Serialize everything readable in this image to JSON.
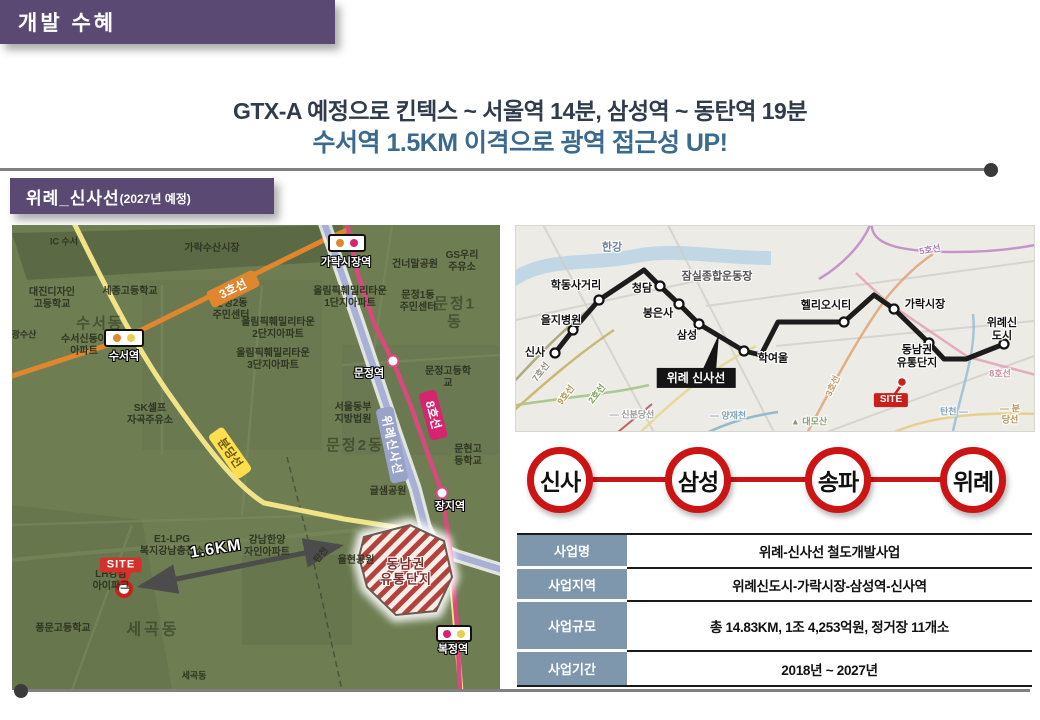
{
  "colors": {
    "banner-purple": "#5a4973",
    "headline-dark": "#303c4c",
    "headline-blue": "#3a6a8e",
    "line-red": "#cc1414",
    "table-header-bg": "#7e97ad",
    "site-red": "#d3322c",
    "map-olive": "#6e7d52",
    "divider-gray": "#808080"
  },
  "header": {
    "tag": "개발 수혜",
    "line1": "GTX-A 예정으로  킨텍스 ~ 서울역 14분, 삼성역 ~ 동탄역 19분",
    "line2": "수서역 1.5KM 이격으로 광역 접근성 UP!"
  },
  "section": {
    "title": "위례_신사선",
    "subtitle": "(2027년 예정)"
  },
  "left_map": {
    "badges": [
      {
        "x": 92,
        "y": 104,
        "w": 40,
        "h": 18,
        "dots": [
          "#e0862f",
          "#e8cf4f"
        ],
        "label": "수서역",
        "lx": 112,
        "ly": 132
      },
      {
        "x": 316,
        "y": 9,
        "w": 38,
        "h": 18,
        "dots": [
          "#e0862f",
          "#d6246e"
        ],
        "label": "가락시장역",
        "lx": 334,
        "ly": 38
      },
      {
        "x": 424,
        "y": 400,
        "w": 36,
        "h": 17,
        "dots": [
          "#d6246e",
          "#e8cf4f"
        ],
        "label": "복정역",
        "lx": 441,
        "ly": 425
      }
    ],
    "labels": [
      {
        "t": "IC 수서",
        "x": 52,
        "y": 17,
        "fs": 9
      },
      {
        "t": "가락수산시장",
        "x": 200,
        "y": 24,
        "fs": 10
      },
      {
        "t": "대진디자인\n고등학교",
        "x": 40,
        "y": 74
      },
      {
        "t": "세종고등학교",
        "x": 118,
        "y": 67
      },
      {
        "t": "수서동",
        "x": 88,
        "y": 99,
        "fs": 15,
        "c": "rgba(42,48,30,0.55)",
        "ls": 2
      },
      {
        "t": "수서신동아\n아파트",
        "x": 72,
        "y": 121
      },
      {
        "t": "광수산",
        "x": 12,
        "y": 110,
        "fs": 9
      },
      {
        "t": "문정2동\n주민센터",
        "x": 219,
        "y": 85
      },
      {
        "t": "올림픽훼밀리타운\n1단지아파트",
        "x": 338,
        "y": 73
      },
      {
        "t": "올림픽훼밀리타운\n2단지아파트",
        "x": 266,
        "y": 104
      },
      {
        "t": "올림픽훼밀리타운\n3단지아파트",
        "x": 261,
        "y": 135
      },
      {
        "t": "건너말공원",
        "x": 403,
        "y": 40
      },
      {
        "t": "GS우리\n주유소",
        "x": 450,
        "y": 37
      },
      {
        "t": "문정1동\n주민센터",
        "x": 406,
        "y": 77
      },
      {
        "t": "문정1동",
        "x": 443,
        "y": 88,
        "fs": 15,
        "c": "rgba(42,48,30,0.55)",
        "ls": 2
      },
      {
        "t": "문정고등학교",
        "x": 436,
        "y": 153
      },
      {
        "t": "SK셀프\n자곡주유소",
        "x": 138,
        "y": 190
      },
      {
        "t": "서울동부\n지방법원",
        "x": 341,
        "y": 189
      },
      {
        "t": "문정2동",
        "x": 343,
        "y": 221,
        "fs": 15,
        "c": "rgba(42,48,30,0.55)",
        "ls": 2
      },
      {
        "t": "문현고등학교",
        "x": 456,
        "y": 231
      },
      {
        "t": "글샘공원",
        "x": 376,
        "y": 267
      },
      {
        "t": "E1-LPG\n복지강남충전소",
        "x": 160,
        "y": 321
      },
      {
        "t": "강남한양\n자인아파트",
        "x": 255,
        "y": 322
      },
      {
        "t": "율현공원",
        "x": 344,
        "y": 336
      },
      {
        "t": "탄천",
        "x": 309,
        "y": 330,
        "rot": -50,
        "fs": 9
      },
      {
        "t": "LH강남\n아이파크",
        "x": 99,
        "y": 356
      },
      {
        "t": "풍문고등학교",
        "x": 51,
        "y": 404
      },
      {
        "t": "세곡동",
        "x": 141,
        "y": 406,
        "fs": 16,
        "c": "rgba(42,48,30,0.55)",
        "ls": 3
      },
      {
        "t": "세곡동",
        "x": 182,
        "y": 451,
        "fs": 9
      },
      {
        "t": "문정역",
        "x": 357,
        "y": 149,
        "c": "#fff",
        "fs": 11,
        "halo": "b",
        "n": "munjeong-station-label"
      },
      {
        "t": "장지역",
        "x": 438,
        "y": 282,
        "c": "#fff",
        "fs": 11,
        "halo": "b",
        "n": "jangji-station-label"
      },
      {
        "t": "동남권\n유통단지",
        "x": 394,
        "y": 347,
        "c": "#7c2f2a",
        "fs": 13,
        "halo": "w",
        "ls": 1,
        "n": "dongnamkwon-area-label"
      },
      {
        "t": "1.6KM",
        "x": 204,
        "y": 325,
        "c": "#fff",
        "fs": 16,
        "halo": "b",
        "rot": -9,
        "ls": 1,
        "n": "distance-label"
      },
      {
        "t": "3호선",
        "x": 221,
        "y": 64,
        "c": "#fff",
        "bg": "#e0862f",
        "fs": 12,
        "rot": -26,
        "pad": "2px 12px",
        "r": 4,
        "n": "line3-badge"
      },
      {
        "t": "분당선",
        "x": 218,
        "y": 228,
        "c": "#6b5a10",
        "bg": "#ffdf4d",
        "fs": 12,
        "rot": 55,
        "pad": "2px 10px",
        "r": 4,
        "n": "bundang-line-badge"
      },
      {
        "t": "위례신사선",
        "x": 380,
        "y": 220,
        "c": "#fff",
        "bg": "#99a2c8",
        "fs": 12,
        "rot": 78,
        "pad": "2px 8px",
        "r": 4,
        "ls": 1,
        "n": "wirye-sinsa-line-badge"
      },
      {
        "t": "8호선",
        "x": 421,
        "y": 190,
        "c": "#fff",
        "bg": "#d6246e",
        "fs": 12,
        "rot": 75,
        "pad": "2px 10px",
        "r": 4,
        "n": "line8-badge"
      },
      {
        "t": "SITE",
        "x": 109,
        "y": 340,
        "c": "#fff",
        "bg": "#d3322c",
        "fs": 11,
        "pad": "1px 7px",
        "r": 3,
        "ls": 1,
        "n": "site-badge"
      }
    ]
  },
  "right_map": {
    "labels": [
      {
        "t": "한강",
        "x": 96,
        "y": 22,
        "fs": 11,
        "c": "#6f85a0"
      },
      {
        "t": "학동사거리",
        "x": 60,
        "y": 60
      },
      {
        "t": "을지병원",
        "x": 45,
        "y": 95
      },
      {
        "t": "신사",
        "x": 19,
        "y": 127
      },
      {
        "t": "청담",
        "x": 126,
        "y": 63
      },
      {
        "t": "봉은사",
        "x": 142,
        "y": 88
      },
      {
        "t": "삼성",
        "x": 171,
        "y": 110
      },
      {
        "t": "학여울",
        "x": 257,
        "y": 133
      },
      {
        "t": "잠실종합운동장",
        "x": 201,
        "y": 51,
        "c": "#555"
      },
      {
        "t": "헬리오시티",
        "x": 310,
        "y": 80
      },
      {
        "t": "가락시장",
        "x": 409,
        "y": 79
      },
      {
        "t": "위례신도시",
        "x": 486,
        "y": 104
      },
      {
        "t": "동남권\n유통단지",
        "x": 401,
        "y": 131
      },
      {
        "t": "7호선",
        "x": 25,
        "y": 146,
        "fs": 9,
        "c": "#8f8f82",
        "rot": -52
      },
      {
        "t": "9호선",
        "x": 50,
        "y": 169,
        "fs": 9,
        "c": "#b09a55",
        "rot": -52
      },
      {
        "t": "2호선",
        "x": 81,
        "y": 168,
        "fs": 9,
        "c": "#7ba05b",
        "rot": -52
      },
      {
        "t": "— 신분당선",
        "x": 116,
        "y": 189,
        "fs": 9,
        "c": "#999999"
      },
      {
        "t": "— 양재천",
        "x": 212,
        "y": 190,
        "fs": 9,
        "c": "#7fa3b5"
      },
      {
        "t": "▲ 대모산",
        "x": 293,
        "y": 196,
        "fs": 9,
        "c": "#8a9a70"
      },
      {
        "t": "3호선",
        "x": 317,
        "y": 160,
        "fs": 9,
        "c": "#c09a6a",
        "rot": -65
      },
      {
        "t": "5호선",
        "x": 414,
        "y": 24,
        "fs": 9,
        "c": "#a87cb4",
        "rot": -10
      },
      {
        "t": "8호선",
        "x": 484,
        "y": 148,
        "fs": 9,
        "c": "#c789a0"
      },
      {
        "t": "탄천 —",
        "x": 438,
        "y": 186,
        "fs": 9,
        "c": "#7fa3b5"
      },
      {
        "t": "— 분당선",
        "x": 494,
        "y": 188,
        "fs": 9,
        "c": "#b0955a"
      },
      {
        "t": "위례 신사선",
        "x": 180,
        "y": 152,
        "c": "#fff",
        "bg": "#151515",
        "fs": 12,
        "pad": "3px 10px",
        "halo": null,
        "n": "wirye-sinsa-line-callout"
      },
      {
        "t": "SITE",
        "x": 375,
        "y": 174,
        "c": "#fff",
        "bg": "#c9201c",
        "fs": 10,
        "pad": "1px 6px",
        "r": 2,
        "halo": null,
        "n": "site-badge"
      }
    ]
  },
  "stations": [
    "신사",
    "삼성",
    "송파",
    "위례"
  ],
  "table": {
    "rows": [
      {
        "label": "사업명",
        "value": "위례-신사선 철도개발사업"
      },
      {
        "label": "사업지역",
        "value": "위례신도시-가락시장-삼성역-신사역"
      },
      {
        "label": "사업규모",
        "value": "총  14.83KM, 1조 4,253억원, 정거장 11개소"
      },
      {
        "label": "사업기간",
        "value": "2018년 ~ 2027년"
      }
    ]
  }
}
